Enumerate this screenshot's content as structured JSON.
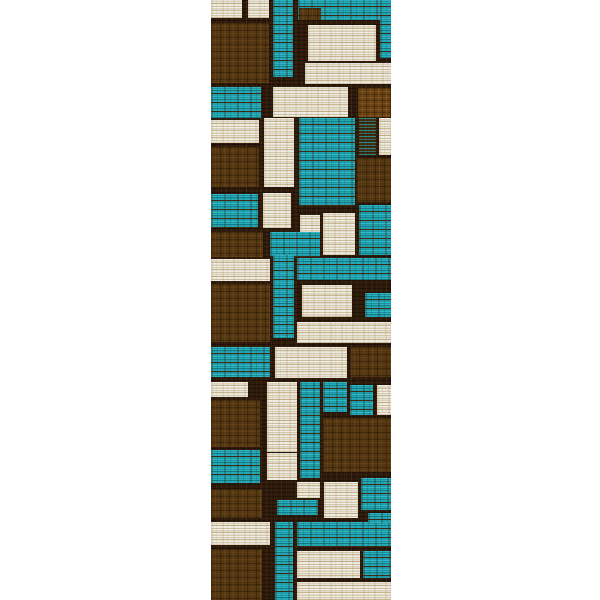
{
  "scene": {
    "description": "Product photo of a geometric color-block patchwork runner rug on a plain white background",
    "background_color": "#ffffff"
  },
  "rug": {
    "left": 211,
    "top": 0,
    "width": 180,
    "height": 600,
    "grout_color": "#2e1a0a",
    "palette": {
      "teal": "#1aa0ae",
      "brown": "#543610",
      "brown_light": "#6b4313",
      "cream": "#e8e3d3",
      "mix": "#46300f"
    },
    "patches": [
      [
        0,
        0,
        31,
        18,
        "cream"
      ],
      [
        37,
        0,
        21,
        18,
        "cream"
      ],
      [
        0,
        23,
        58,
        60,
        "brown"
      ],
      [
        62,
        0,
        20,
        77,
        "teal"
      ],
      [
        87,
        0,
        93,
        20,
        "teal"
      ],
      [
        88,
        8,
        22,
        12,
        "brown"
      ],
      [
        169,
        0,
        11,
        58,
        "teal"
      ],
      [
        97,
        25,
        68,
        36,
        "cream"
      ],
      [
        94,
        63,
        86,
        21,
        "cream"
      ],
      [
        0,
        87,
        50,
        31,
        "teal"
      ],
      [
        62,
        87,
        75,
        30,
        "cream"
      ],
      [
        147,
        88,
        33,
        29,
        "brown_light"
      ],
      [
        0,
        120,
        48,
        23,
        "cream"
      ],
      [
        0,
        147,
        48,
        40,
        "brown"
      ],
      [
        53,
        118,
        30,
        69,
        "cream"
      ],
      [
        88,
        118,
        56,
        88,
        "teal"
      ],
      [
        148,
        118,
        17,
        37,
        "mix"
      ],
      [
        168,
        118,
        12,
        37,
        "cream"
      ],
      [
        146,
        158,
        34,
        44,
        "brown"
      ],
      [
        0,
        194,
        47,
        34,
        "teal"
      ],
      [
        52,
        193,
        28,
        35,
        "cream"
      ],
      [
        89,
        215,
        20,
        18,
        "cream"
      ],
      [
        112,
        213,
        32,
        42,
        "cream"
      ],
      [
        148,
        205,
        32,
        50,
        "teal"
      ],
      [
        0,
        232,
        52,
        25,
        "brown"
      ],
      [
        59,
        232,
        50,
        25,
        "teal"
      ],
      [
        0,
        259,
        59,
        22,
        "cream"
      ],
      [
        62,
        255,
        21,
        83,
        "teal"
      ],
      [
        86,
        258,
        94,
        22,
        "teal"
      ],
      [
        91,
        285,
        50,
        32,
        "cream"
      ],
      [
        154,
        293,
        26,
        24,
        "teal"
      ],
      [
        0,
        284,
        59,
        58,
        "brown"
      ],
      [
        86,
        322,
        94,
        21,
        "cream"
      ],
      [
        0,
        347,
        59,
        30,
        "teal"
      ],
      [
        64,
        347,
        72,
        31,
        "cream"
      ],
      [
        139,
        347,
        41,
        30,
        "brown"
      ],
      [
        0,
        382,
        37,
        15,
        "cream"
      ],
      [
        56,
        382,
        30,
        70,
        "cream"
      ],
      [
        89,
        382,
        20,
        96,
        "teal"
      ],
      [
        112,
        382,
        24,
        30,
        "teal"
      ],
      [
        139,
        385,
        23,
        30,
        "teal"
      ],
      [
        166,
        385,
        14,
        30,
        "cream"
      ],
      [
        0,
        400,
        49,
        47,
        "brown"
      ],
      [
        112,
        418,
        68,
        54,
        "brown"
      ],
      [
        0,
        450,
        49,
        33,
        "teal"
      ],
      [
        56,
        453,
        30,
        27,
        "cream"
      ],
      [
        86,
        482,
        23,
        16,
        "cream"
      ],
      [
        113,
        482,
        34,
        36,
        "cream"
      ],
      [
        150,
        478,
        30,
        32,
        "teal"
      ],
      [
        0,
        489,
        51,
        29,
        "brown"
      ],
      [
        66,
        500,
        41,
        15,
        "teal"
      ],
      [
        0,
        522,
        59,
        23,
        "cream"
      ],
      [
        0,
        549,
        51,
        51,
        "brown"
      ],
      [
        64,
        522,
        18,
        78,
        "teal"
      ],
      [
        86,
        522,
        94,
        25,
        "teal"
      ],
      [
        157,
        513,
        23,
        10,
        "teal"
      ],
      [
        86,
        551,
        63,
        27,
        "cream"
      ],
      [
        152,
        551,
        28,
        27,
        "teal"
      ],
      [
        86,
        582,
        94,
        18,
        "cream"
      ]
    ]
  }
}
